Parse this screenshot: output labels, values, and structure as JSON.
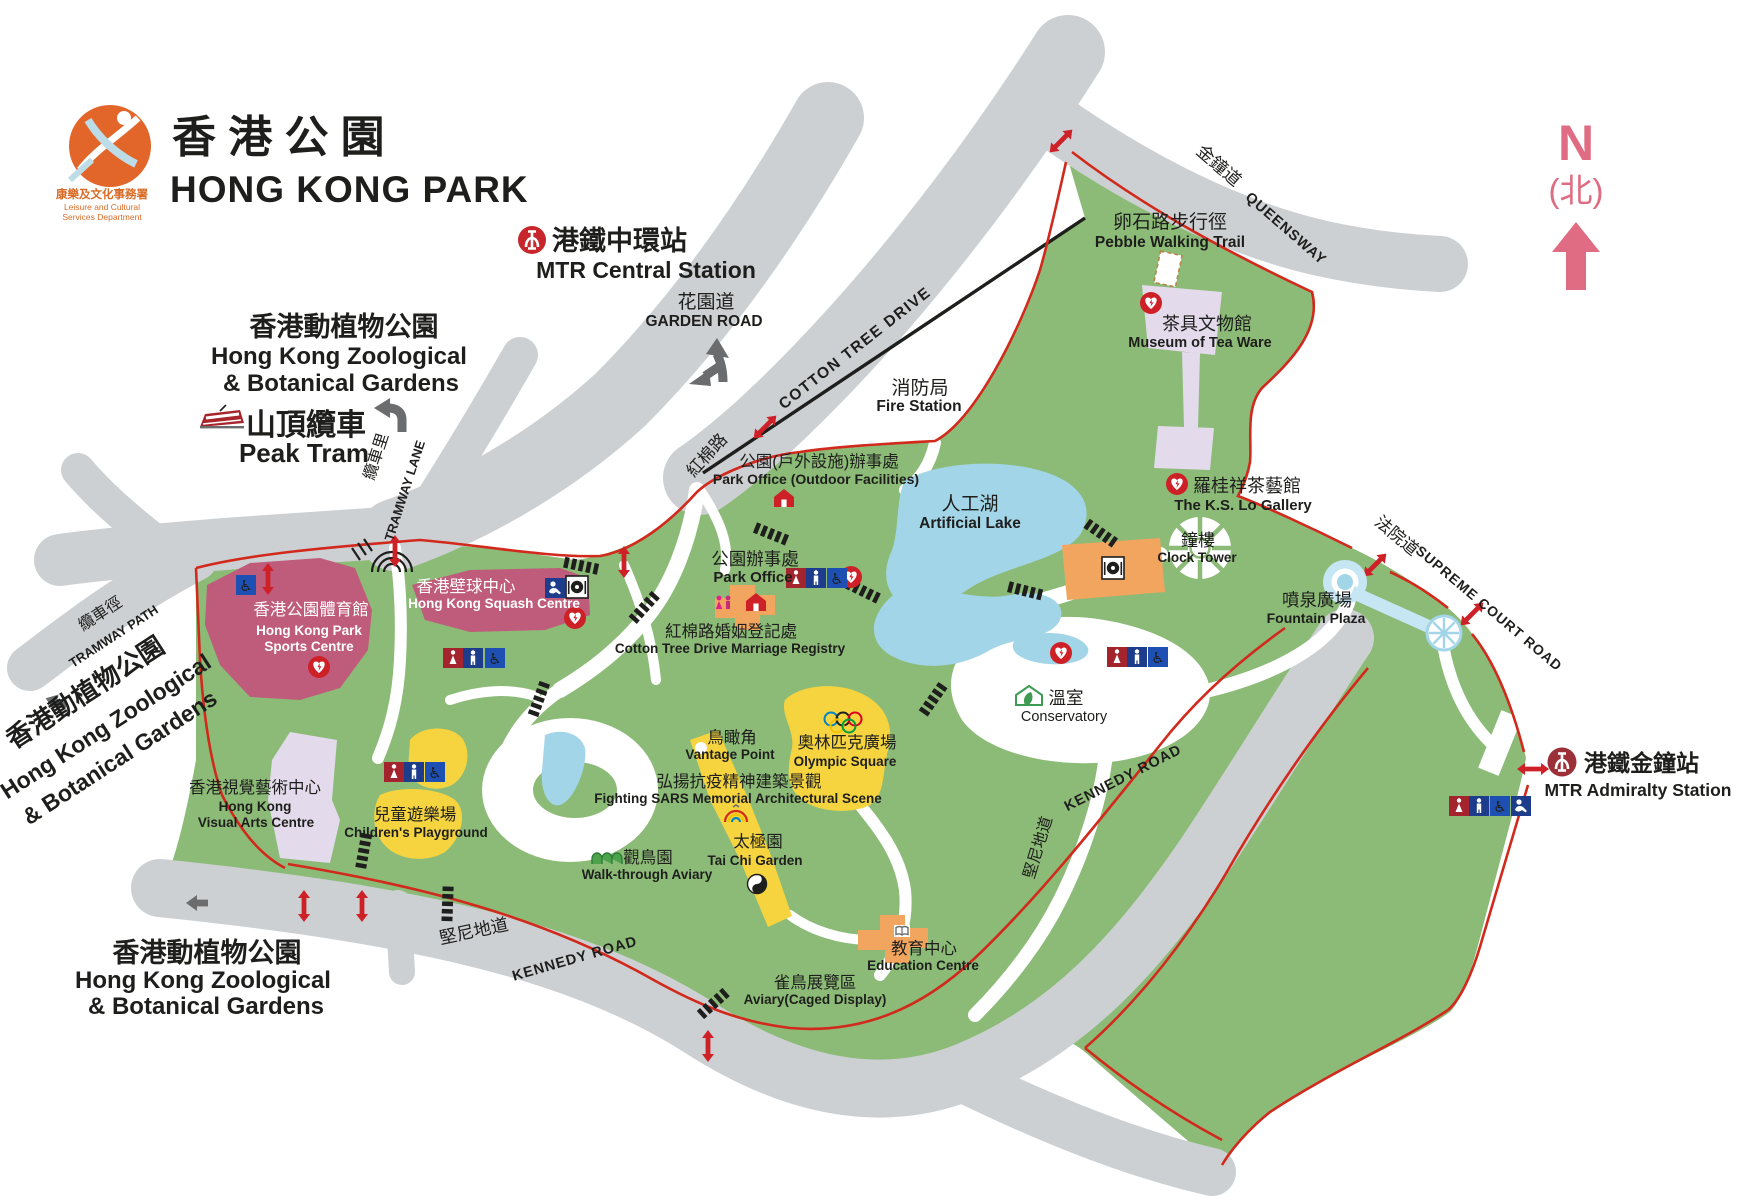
{
  "meta": {
    "title_zh": "香 港 公 園",
    "title_en": "HONG KONG PARK",
    "dept_zh": "康樂及文化事務署",
    "dept_en1": "Leisure and Cultural",
    "dept_en2": "Services Department"
  },
  "compass": {
    "n": "N",
    "north_zh": "(北)"
  },
  "stations": {
    "central": {
      "zh": "港鐵中環站",
      "en": "MTR Central Station"
    },
    "admiralty": {
      "zh": "港鐵金鐘站",
      "en": "MTR Admiralty Station"
    }
  },
  "roads": {
    "garden": {
      "zh": "花園道",
      "en": "GARDEN ROAD"
    },
    "cotton_tree_drive": {
      "en": "COTTON TREE DRIVE",
      "zh": "紅棉路"
    },
    "queensway": {
      "zh": "金鐘道",
      "en": "QUEENSWAY"
    },
    "tramway_lane": {
      "zh": "纜車里",
      "en": "TRAMWAY LANE"
    },
    "tramway_path": {
      "zh": "纜車徑",
      "en": "TRAMWAY PATH"
    },
    "supreme_court": {
      "zh": "法院道",
      "en": "SUPREME COURT ROAD"
    },
    "kennedy": {
      "zh": "堅尼地道",
      "en": "KENNEDY ROAD"
    }
  },
  "poi": {
    "pebble_trail": {
      "zh": "卵石路步行徑",
      "en": "Pebble Walking Trail"
    },
    "tea_ware": {
      "zh": "茶具文物館",
      "en": "Museum of Tea Ware"
    },
    "ks_lo": {
      "zh": "羅桂祥茶藝館",
      "en": "The K.S. Lo Gallery"
    },
    "fire_station": {
      "zh": "消防局",
      "en": "Fire Station"
    },
    "park_office_outdoor": {
      "zh": "公園(戶外設施)辦事處",
      "en": "Park Office (Outdoor Facilities)"
    },
    "park_office": {
      "zh": "公園辦事處",
      "en": "Park Office"
    },
    "lake": {
      "zh": "人工湖",
      "en": "Artificial Lake"
    },
    "clock_tower": {
      "zh": "鐘樓",
      "en": "Clock Tower"
    },
    "fountain": {
      "zh": "噴泉廣場",
      "en": "Fountain Plaza"
    },
    "sports_centre": {
      "zh": "香港公園體育館",
      "en1": "Hong Kong Park",
      "en2": "Sports Centre"
    },
    "squash_centre": {
      "zh": "香港壁球中心",
      "en": "Hong Kong Squash Centre"
    },
    "marriage_registry": {
      "zh": "紅棉路婚姻登記處",
      "en": "Cotton Tree Drive Marriage Registry"
    },
    "conservatory": {
      "zh": "溫室",
      "en": "Conservatory"
    },
    "vantage_point": {
      "zh": "鳥瞰角",
      "en": "Vantage Point"
    },
    "olympic_square": {
      "zh": "奧林匹克廣場",
      "en": "Olympic Square"
    },
    "sars_memorial": {
      "zh": "弘揚抗疫精神建築景觀",
      "en": "Fighting SARS Memorial Architectural Scene"
    },
    "tai_chi": {
      "zh": "太極園",
      "en": "Tai Chi Garden"
    },
    "aviary_walk": {
      "zh": "觀鳥園",
      "en": "Walk-through Aviary"
    },
    "visual_arts": {
      "zh": "香港視覺藝術中心",
      "en1": "Hong Kong",
      "en2": "Visual Arts Centre"
    },
    "playground": {
      "zh": "兒童遊樂場",
      "en": "Children's Playground"
    },
    "aviary_caged": {
      "zh": "雀鳥展覽區",
      "en": "Aviary(Caged Display)"
    },
    "education": {
      "zh": "教育中心",
      "en": "Education Centre"
    }
  },
  "external": {
    "peak_tram": {
      "zh": "山頂纜車",
      "en": "Peak Tram"
    },
    "zoo": {
      "zh": "香港動植物公園",
      "en1": "Hong Kong Zoological",
      "en2": "& Botanical Gardens"
    }
  },
  "icons": {
    "accessible_glyph": "♿",
    "aed-icon": "defibrillator-heart",
    "toilets-icon": "male-female-toilet",
    "accessible-icon": "wheelchair-access",
    "baby-care-icon": "baby-care-room",
    "restaurant-icon": "restaurant-plate",
    "mtr-icon": "mtr-logo",
    "tram-icon": "peak-tram-car",
    "house-icon": "office-building",
    "couple-icon": "marriage-couple",
    "book-icon": "education-book",
    "conservatory-icon": "greenhouse",
    "aviary-icon": "aviary-canopy",
    "yin-yang-icon": "tai-chi-symbol",
    "olympic-rings-icon": "olympic-rings",
    "rainbow-icon": "sars-memorial-rainbow",
    "crosswalk-icon": "zebra-crossing",
    "entrance-arrow-icon": "park-entrance",
    "north-arrow-icon": "north-arrow",
    "clock-tower-icon": "clock-tower-plaza",
    "fountain-icon": "fountain",
    "direction-arrow-icon": "one-way-arrow"
  },
  "colors": {
    "park_green": "#8cbb77",
    "road_grey": "#cdd0d3",
    "boundary_red": "#d2291d",
    "building_pink": "#c05c7b",
    "building_lavender": "#e3daeb",
    "building_orange": "#f2a55f",
    "area_yellow": "#f5d440",
    "water_blue": "#a3d5e8",
    "icon_blue": "#1e4396",
    "icon_red": "#ce2127",
    "mtr_central_red": "#c6262c",
    "mtr_admiralty_red": "#9c3038",
    "compass_pink": "#df6c82",
    "logo_orange": "#e2662a"
  }
}
